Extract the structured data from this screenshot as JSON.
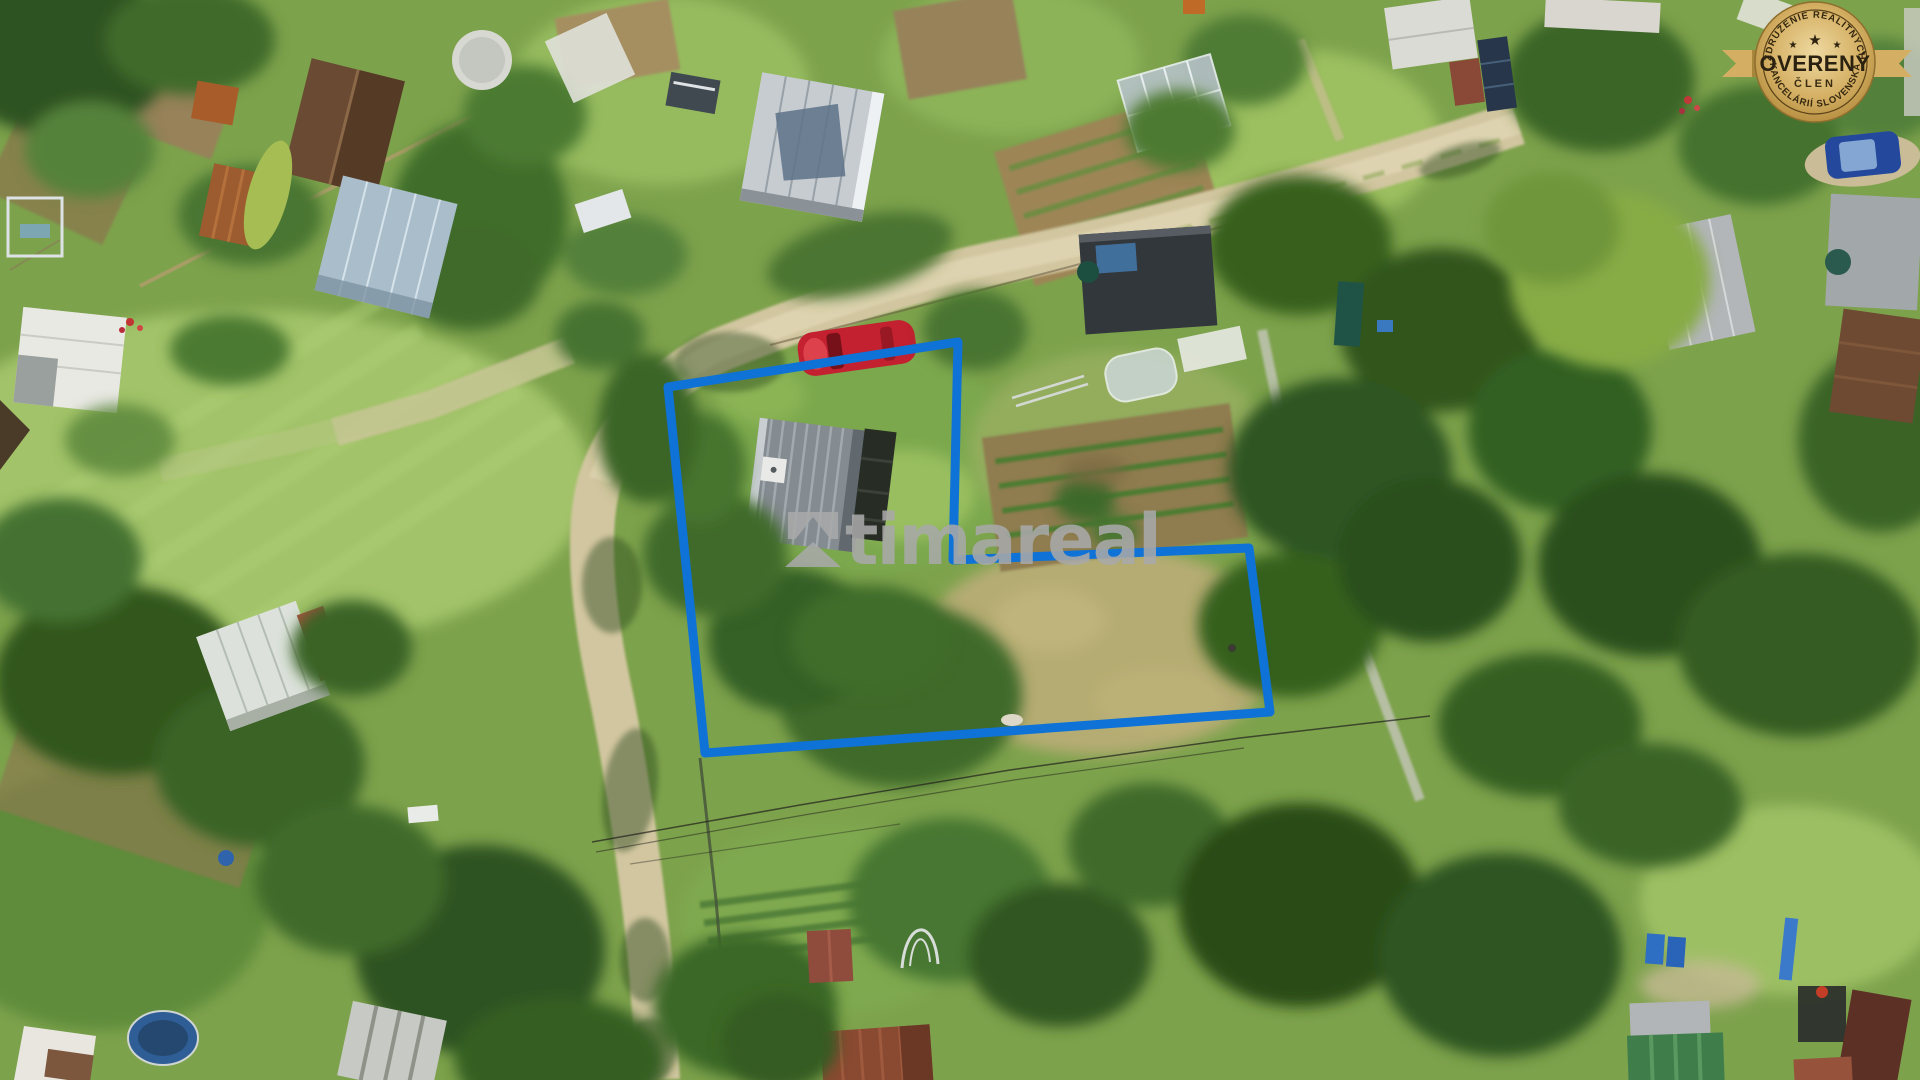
{
  "watermark": {
    "text": "timareal"
  },
  "badge": {
    "top_arc": "ZDRUŽENIE REALITNÝCH",
    "title": "OVERENÝ",
    "subtitle": "ČLEN",
    "bottom_arc": "KANCELÁRIÍ SLOVENSKA",
    "star": "★"
  },
  "colors": {
    "boundary_blue": "#0f72d6",
    "watermark_gray": "#a8a8a8",
    "badge_gold_light": "#eed9a0",
    "badge_gold_mid": "#d4af63",
    "badge_gold_dark": "#b28a3c",
    "badge_text": "#2b2110"
  }
}
